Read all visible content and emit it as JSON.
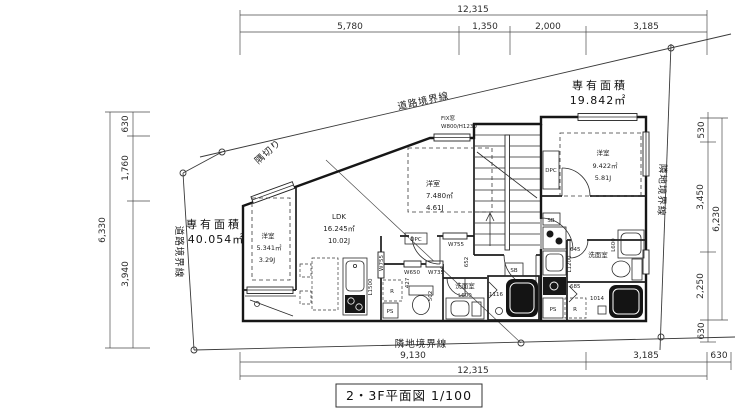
{
  "title_block": {
    "text": "2・3F平面図 1/100"
  },
  "boundaries": {
    "road_top": "道路境界線",
    "road_left": "道路境界線",
    "neighbor_right": "隣地境界線",
    "neighbor_bottom": "隣地境界線",
    "corner_cut": "隅切り"
  },
  "units": {
    "left": {
      "caption": "専有面積",
      "area": "40.054㎡"
    },
    "right": {
      "caption": "専有面積",
      "area": "19.842㎡"
    }
  },
  "dims": {
    "top": {
      "total": "12,315",
      "seg": [
        "5,780",
        "1,350",
        "2,000",
        "3,185"
      ]
    },
    "bottom": {
      "total": "12,315",
      "seg": [
        "9,130",
        "3,185",
        "630"
      ]
    },
    "left": {
      "total": "6,330",
      "seg": [
        "630",
        "1,760",
        "3,940"
      ]
    },
    "right": {
      "total": "6,230",
      "seg": [
        "530",
        "3,450",
        "2,250",
        "630"
      ]
    }
  },
  "rooms": {
    "bedroom_left": {
      "name": "洋室",
      "area": "5.341㎡",
      "tatami": "3.29J"
    },
    "ldk": {
      "name": "LDK",
      "area": "16.245㎡",
      "tatami": "10.02J"
    },
    "bedroom_mid": {
      "name": "洋室",
      "area": "7.480㎡",
      "tatami": "4.61J"
    },
    "bedroom_right": {
      "name": "洋室",
      "area": "9.422㎡",
      "tatami": "5.81J"
    },
    "washroom_mid": {
      "name": "洗面室",
      "vanity": "L600"
    },
    "washroom_right": {
      "name": "洗面室",
      "vanity": "L600"
    }
  },
  "labels": {
    "fix_window": "FIX窓",
    "fix_window_size": "W800/H1230",
    "kitchen_left": "L1500",
    "kitchen_right": "L1200",
    "bath_mid": "1116",
    "bath_right": "1014",
    "w755_a": "W755",
    "w755_b": "W755",
    "w650": "W650",
    "w735": "W735",
    "d652": "652",
    "d645": "645",
    "d685": "685",
    "d502": "502",
    "d427": "427",
    "sb_left": "SB",
    "sb_right": "SB",
    "fridge_left": "R",
    "fridge_right": "R",
    "ps_left": "PS",
    "ps_right": "PS",
    "dpc_left": "DPC",
    "dpc_right": "DPC"
  }
}
